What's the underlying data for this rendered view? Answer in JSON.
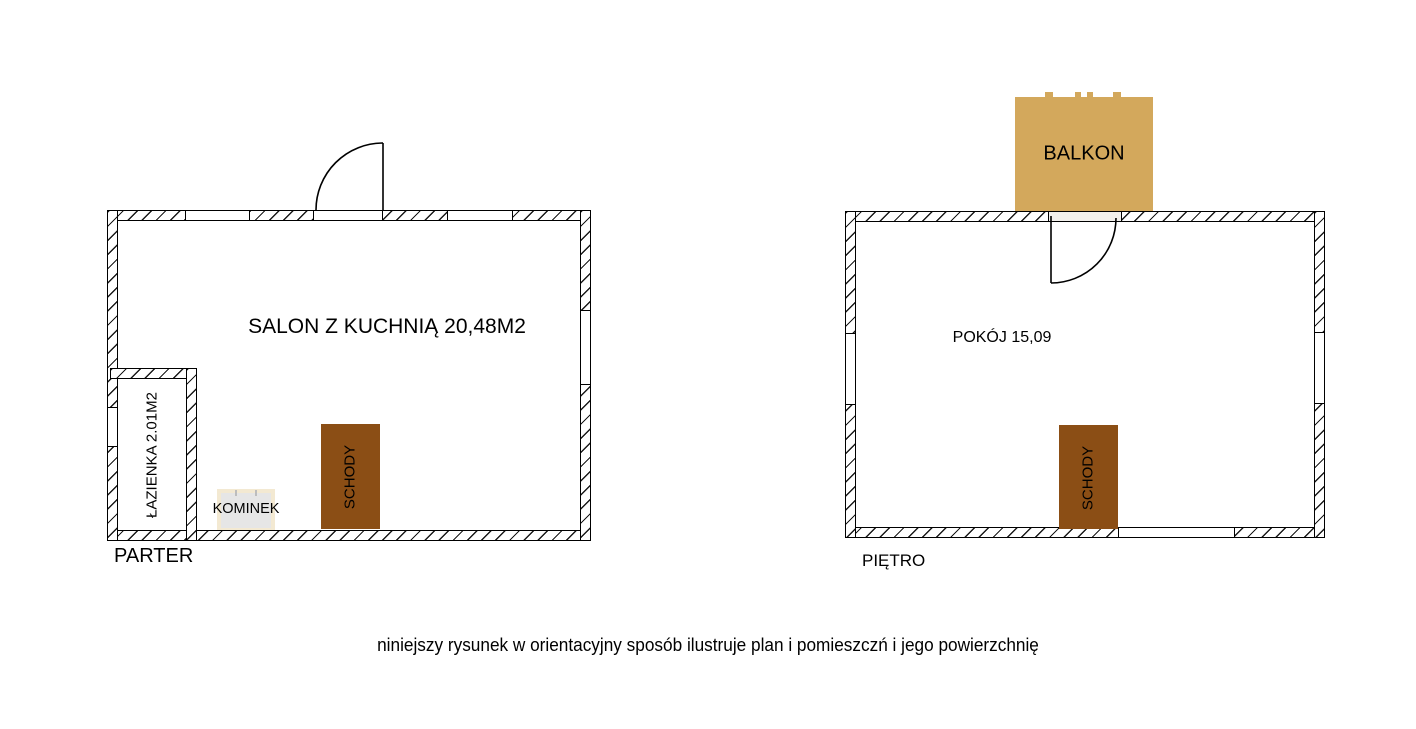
{
  "caption": "niniejszy rysunek w orientacyjny sposób ilustruje plan i pomieszczń i jego powierzchnię",
  "colors": {
    "balcony": "#D3A85C",
    "stairs": "#8B4E15",
    "fireplace_fill": "#E6E6E6",
    "fireplace_frame": "#F3E9D2",
    "wall_line": "#000000"
  },
  "parter": {
    "floor_label": "PARTER",
    "room_label": "SALON Z KUCHNIĄ 20,48M2",
    "bathroom_label": "ŁAZIENKA 2.01M2",
    "fireplace_label": "KOMINEK",
    "stairs_label": "SCHODY"
  },
  "pietro": {
    "floor_label": "PIĘTRO",
    "room_label": "POKÓJ 15,09",
    "balcony_label": "BALKON",
    "stairs_label": "SCHODY"
  }
}
